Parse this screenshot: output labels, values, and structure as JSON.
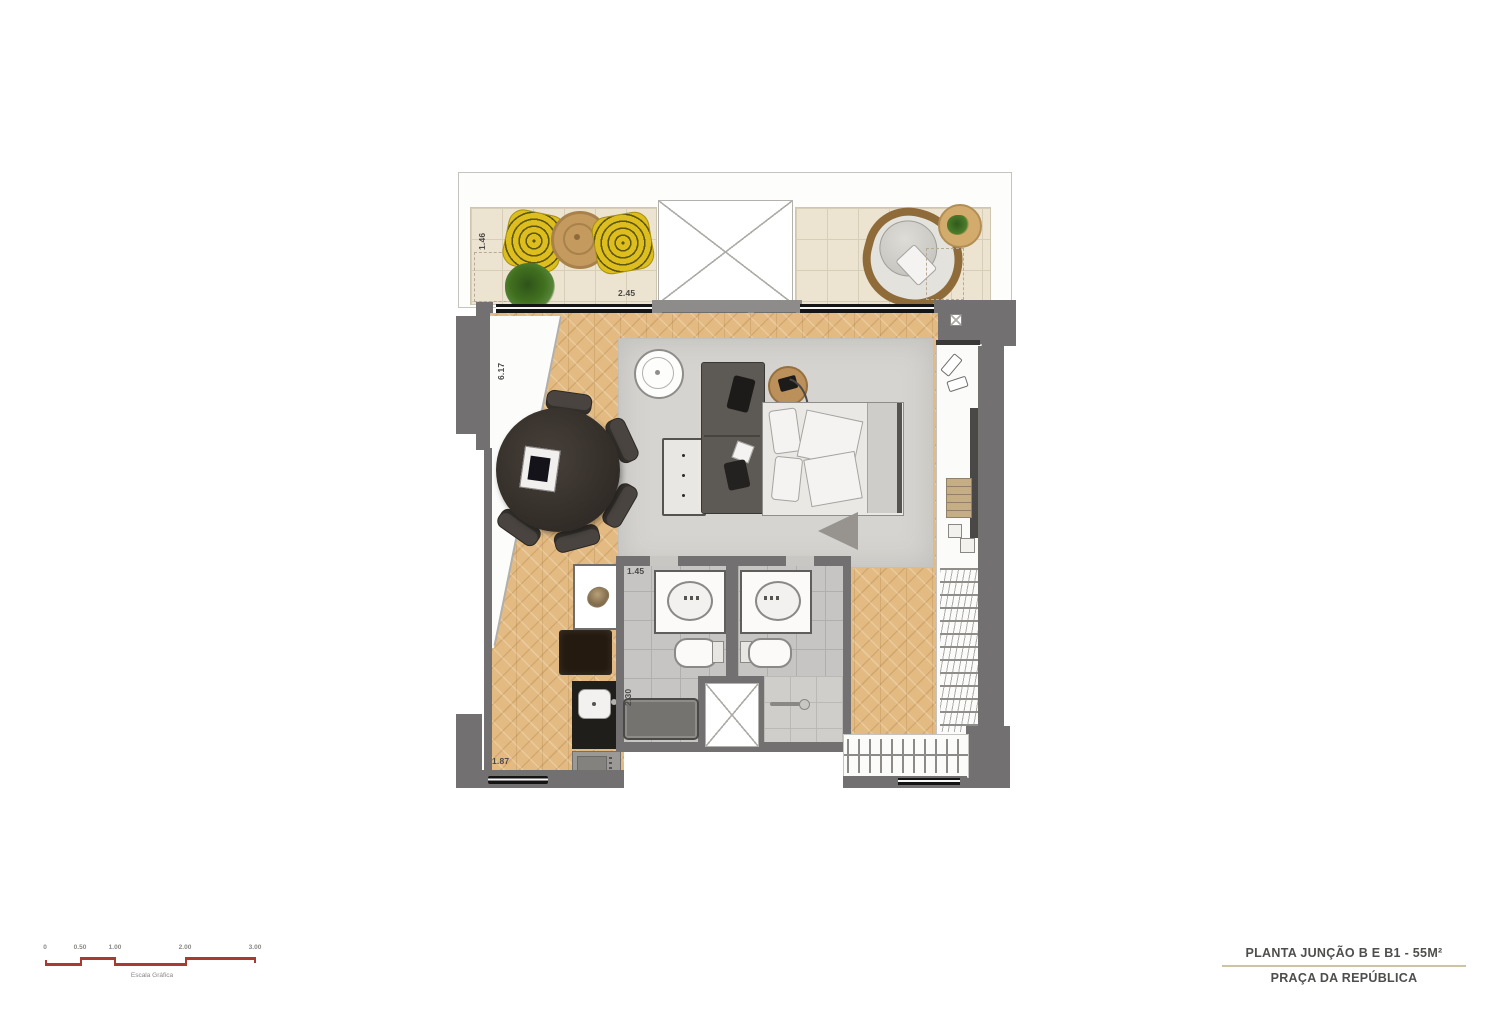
{
  "title_block": {
    "line1": "PLANTA JUNÇÃO B E B1 - 55M²",
    "line2": "PRAÇA DA REPÚBLICA"
  },
  "scale_bar": {
    "labels": [
      "0",
      "0.50",
      "1.00",
      "2.00",
      "3.00"
    ],
    "caption": "Escala Gráfica"
  },
  "dimensions": {
    "balcony_depth": "1.46",
    "balcony_width": "2.45",
    "living_length": "6.17",
    "bathroom_width": "1.45",
    "bathroom_depth": "2.30",
    "kitchen_width": "1.87"
  },
  "colors": {
    "scale_red": "#a93a31",
    "wall_gray": "#727070",
    "wood_floor": "#e3bb82",
    "balcony_tile": "#ece3d0",
    "bath_tile": "#c6c5c3",
    "accent_yellow": "#ddbe1e",
    "title_divider": "#cfc3a6",
    "rug_gray": "#d6d4d0"
  }
}
